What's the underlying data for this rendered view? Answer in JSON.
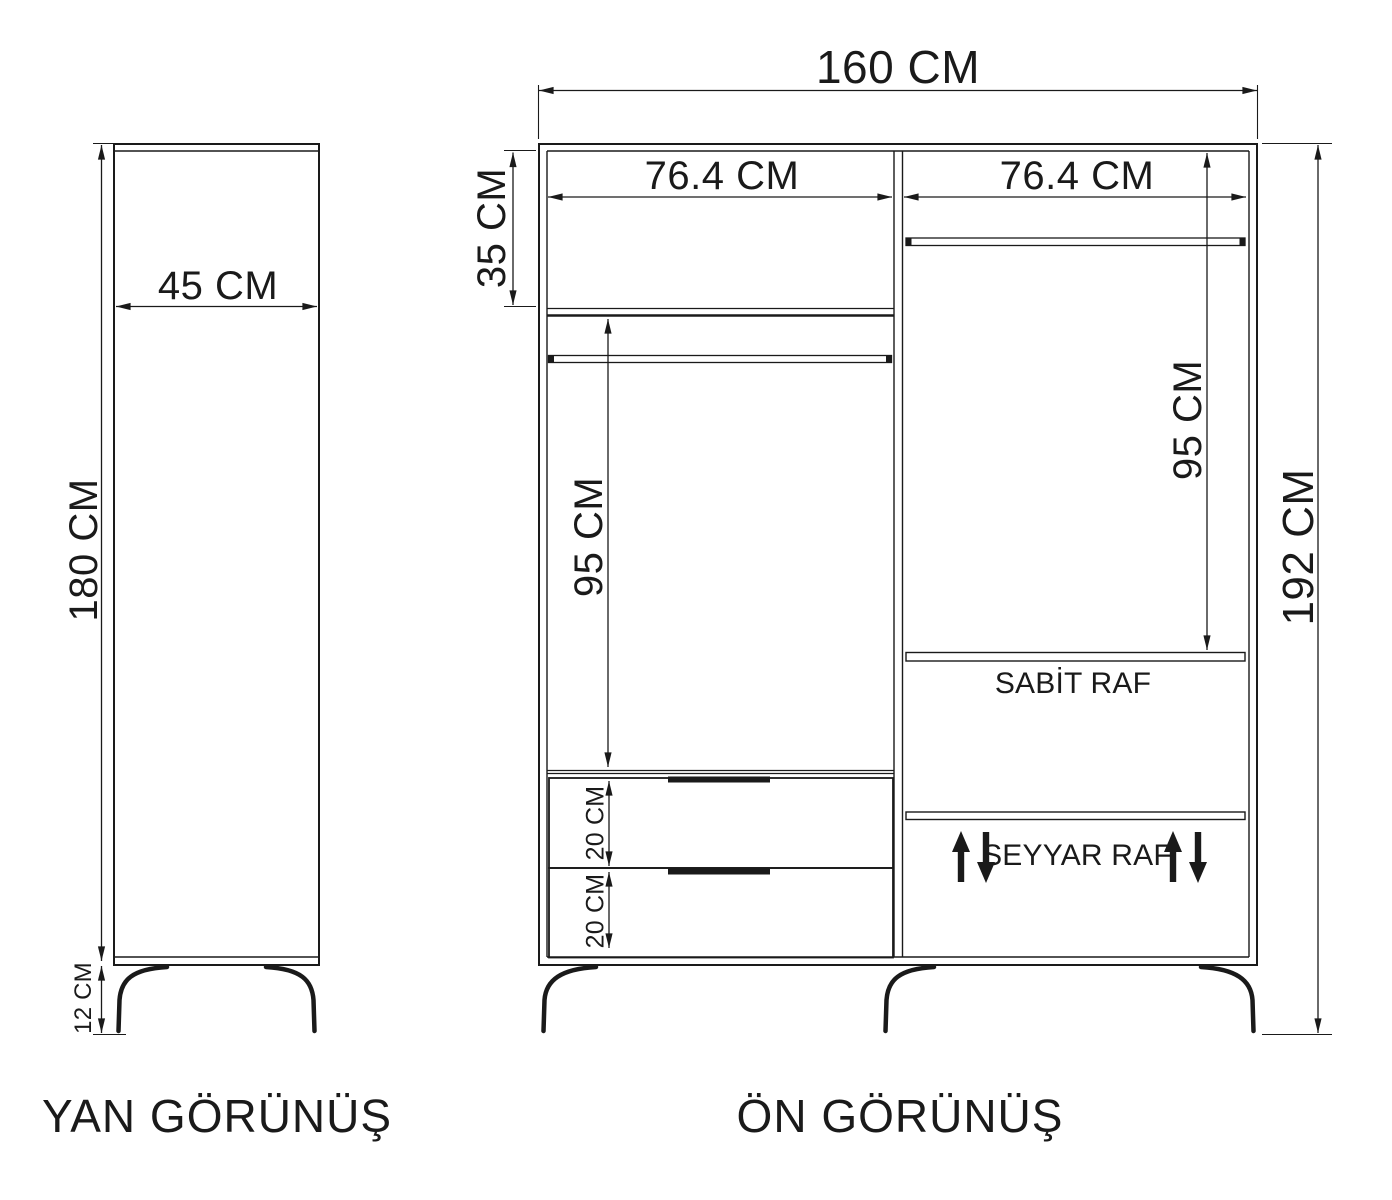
{
  "ink_color": "#1a1a1a",
  "background_color": "#ffffff",
  "side_view": {
    "title": "YAN GÖRÜNÜŞ",
    "depth": "45 CM",
    "body_height": "180 CM",
    "leg_height": "12 CM"
  },
  "front_view": {
    "title": "ÖN GÖRÜNÜŞ",
    "total_width": "160 CM",
    "total_height": "192 CM",
    "top_shelf_height": "35 CM",
    "left_column": {
      "inner_width": "76.4 CM",
      "hanging_space_height": "95 CM",
      "drawer_heights": [
        "20 CM",
        "20 CM"
      ]
    },
    "right_column": {
      "inner_width": "76.4 CM",
      "hanging_space_height": "95 CM",
      "fixed_shelf": "SABİT RAF",
      "movable_shelf": "SEYYAR RAF"
    }
  }
}
